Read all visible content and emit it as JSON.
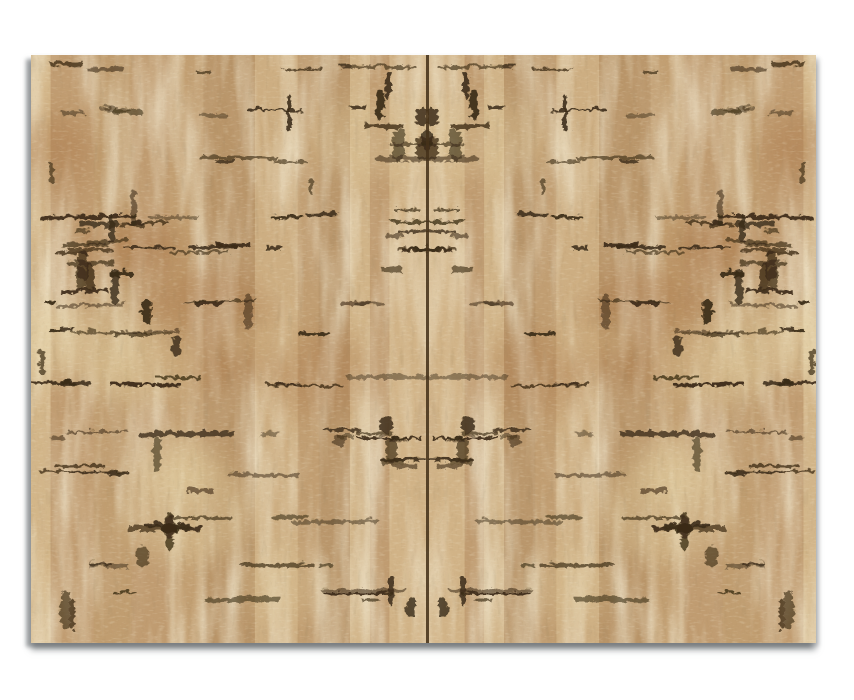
{
  "meta": {
    "description": "Natural cork fabric texture sample: two horizontally mirrored cork panels joined by a dark vertical center seam, photographed on a plain white background with a soft gray drop shadow along the left and bottom edges.",
    "visible_text": "none"
  },
  "palette": {
    "page_background": "#ffffff",
    "cork_base": "#c6a478",
    "cork_cream": "#e4d0a2",
    "cork_tan_mid": "#b48d60",
    "cork_brown_deep": "#9c7348",
    "cork_rust": "#a5703f",
    "dark_mark": "#3a2a15",
    "seam": "#46321a",
    "shadow_gray": "rgba(105,110,114,0.6)"
  },
  "panel": {
    "left_px": 31,
    "top_px": 55,
    "width_px": 785,
    "height_px": 588,
    "seam_x_page_px": 427,
    "half_width_px": 396
  },
  "generator": {
    "seed": 1337,
    "column_min_w": 10,
    "column_max_w": 62,
    "dash_bands": 13,
    "band_spacing": 44,
    "dashes_per_band_min": 3,
    "dashes_per_band_max": 7,
    "vertical_blobs": 14,
    "rust_patches": 7,
    "cream_spots": 8,
    "cluster_centers": [
      [
        374,
        70
      ],
      [
        385,
        190
      ],
      [
        82,
        172
      ],
      [
        58,
        218
      ],
      [
        150,
        452
      ],
      [
        340,
        390
      ]
    ],
    "cluster_items": 8
  }
}
